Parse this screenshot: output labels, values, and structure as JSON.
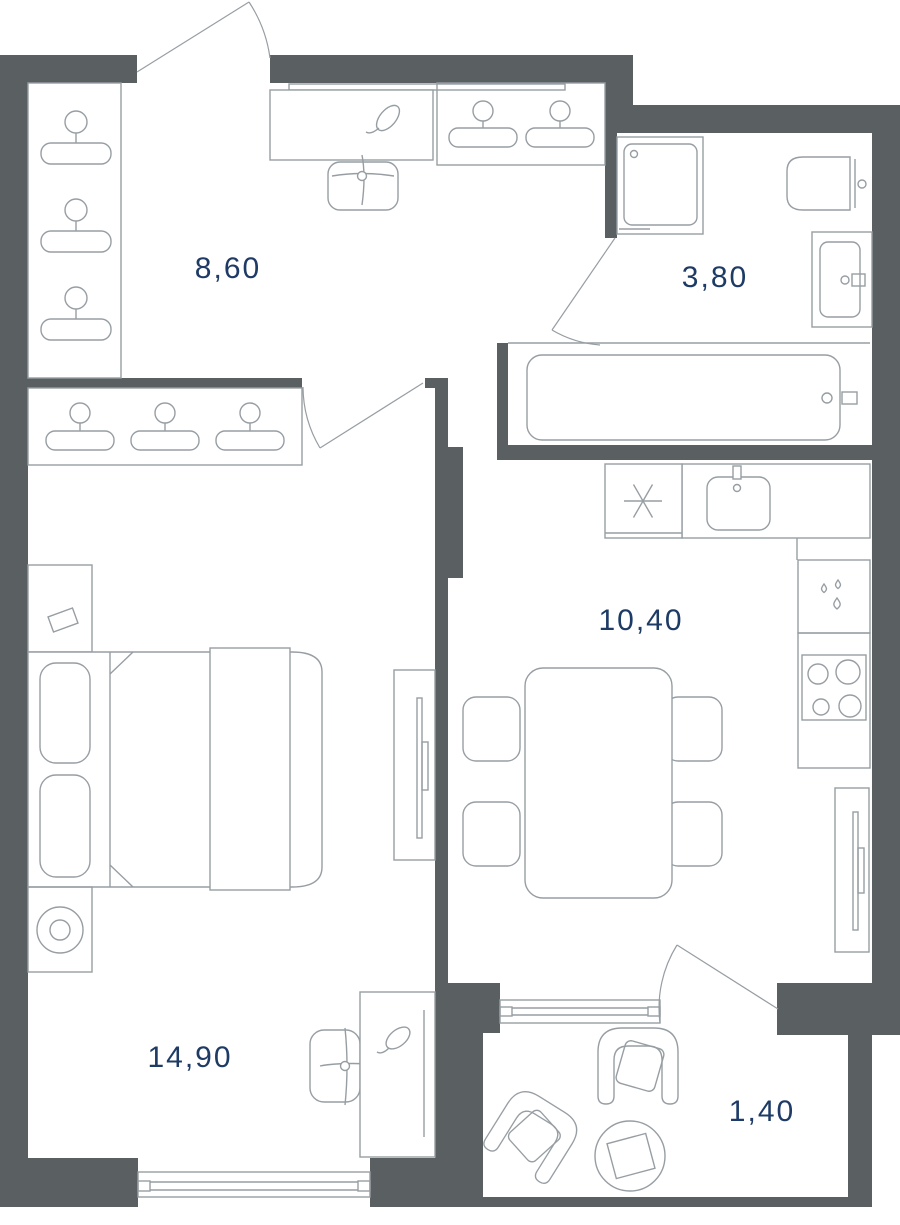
{
  "title": "Apartment floor plan",
  "colors": {
    "wall": "#5a5f62",
    "furniture_line": "#979ea3",
    "label_ink": "#1e3b66",
    "background": "#ffffff"
  },
  "rooms": [
    {
      "name": "hallway",
      "area": "8,60"
    },
    {
      "name": "bathroom",
      "area": "3,80"
    },
    {
      "name": "kitchen-living",
      "area": "10,40"
    },
    {
      "name": "bedroom",
      "area": "14,90"
    },
    {
      "name": "balcony",
      "area": "1,40"
    }
  ],
  "icons": {
    "hanger-icon": "clothes hanger (wardrobe)",
    "plant-icon": "decorative plant sprig",
    "swivel-chair-icon": "chair cross symbol",
    "fridge-icon": "asterisk / snowflake",
    "sink-icon": "basin with tap",
    "drops-icon": "water drops (dishwasher)",
    "stove-icon": "4-burner cooktop",
    "toilet-icon": "toilet with cistern",
    "bathtub-icon": "bathtub with tap",
    "washer-icon": "washing machine",
    "tv-icon": "wall-mounted TV",
    "bed-icon": "double bed with pillows",
    "armchair-icon": "armchair",
    "round-table-icon": "round coffee table",
    "window-icon": "window",
    "door-arc-icon": "door swing arc"
  }
}
